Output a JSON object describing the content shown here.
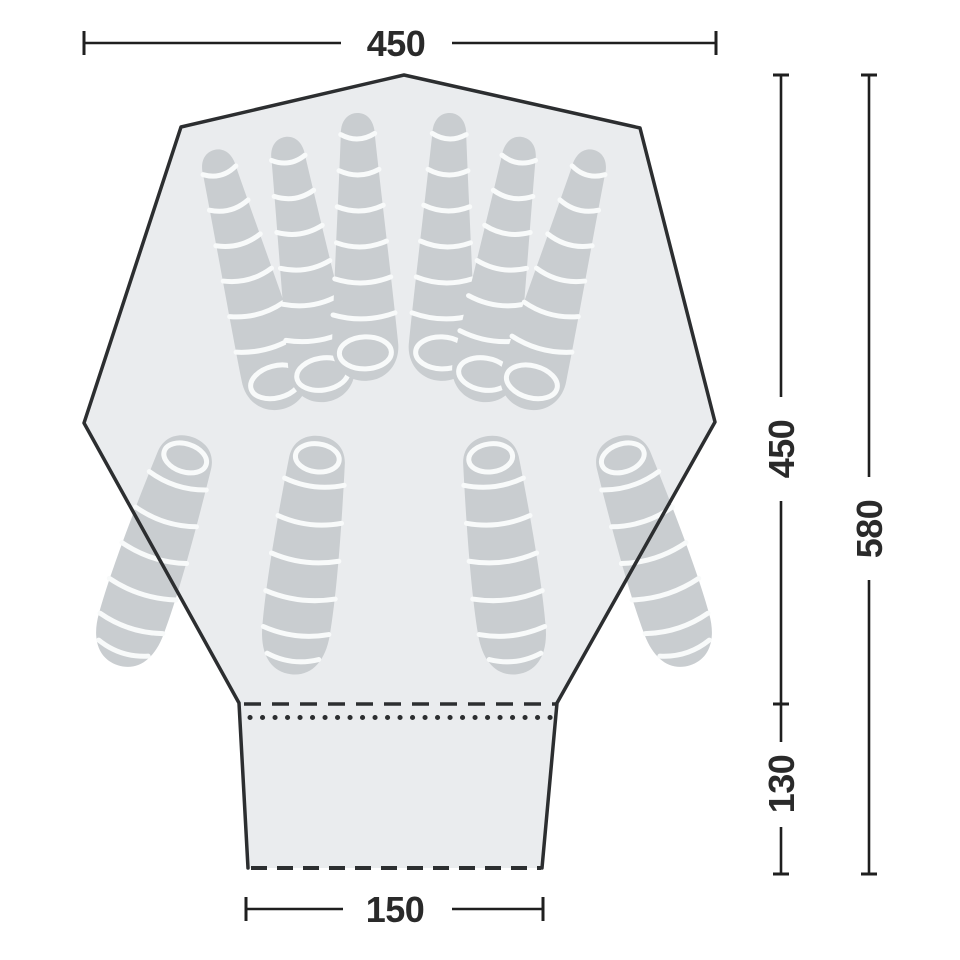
{
  "page": {
    "background": "#ffffff",
    "description": "Tent floor plan diagram with sleeping bags and outside dimensions"
  },
  "colors": {
    "tent_fill": "#eaecee",
    "outline": "#2c2e30",
    "bag_fill": "#c9cdd0",
    "bag_stripe": "#f8fafa",
    "dimension_line": "#1f1f1f",
    "label_text": "#2a2a2a"
  },
  "dimensions": {
    "top_width": {
      "value": "450"
    },
    "inner_depth": {
      "value": "450"
    },
    "total_depth": {
      "value": "580"
    },
    "porch_depth": {
      "value": "130"
    },
    "porch_width": {
      "value": "150"
    }
  },
  "diagram": {
    "type": "tent-floorplan",
    "sleeping_bag_count": 10,
    "top_row_bags": [
      {
        "x": 214,
        "y": 150,
        "r": -15
      },
      {
        "x": 285,
        "y": 137,
        "r": -9
      },
      {
        "x": 357,
        "y": 113,
        "r": -2
      },
      {
        "x": 450,
        "y": 113,
        "r": 2
      },
      {
        "x": 522,
        "y": 137,
        "r": 9
      },
      {
        "x": 594,
        "y": 150,
        "r": 15
      }
    ],
    "bottom_row_bags": [
      {
        "x": 192,
        "y": 437,
        "r": 18
      },
      {
        "x": 320,
        "y": 436,
        "r": 7
      },
      {
        "x": 488,
        "y": 436,
        "r": -7
      },
      {
        "x": 616,
        "y": 437,
        "r": -18
      }
    ]
  }
}
